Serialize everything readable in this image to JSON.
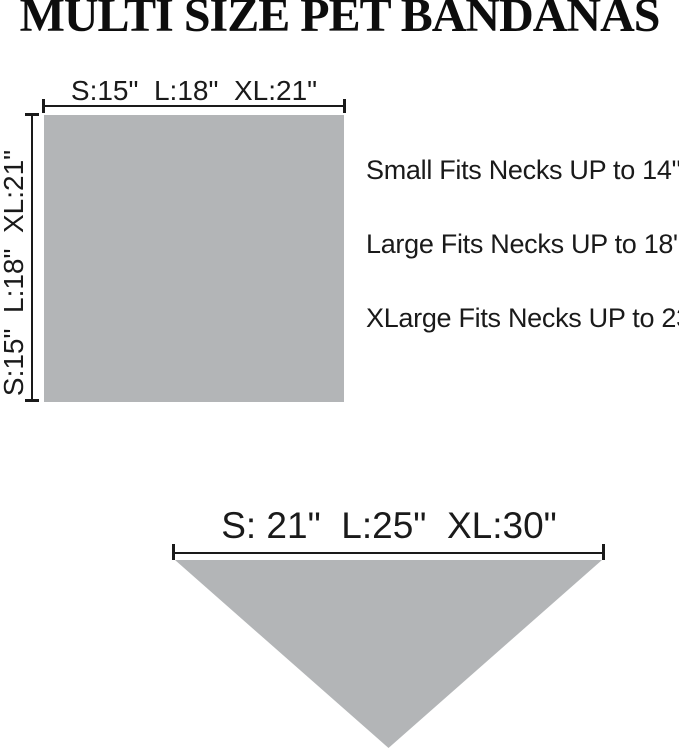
{
  "title": "MULTI SIZE PET BANDANAS",
  "colors": {
    "shape_fill": "#b3b5b7",
    "line": "#1a1a1a",
    "text": "#1a1a1a"
  },
  "square_diagram": {
    "width_label": "S:15\"  L:18\"  XL:21\"",
    "height_label": "S:15\"  L:18\"  XL:21\""
  },
  "fit_notes": [
    "Small Fits Necks UP to 14\"",
    "Large Fits Necks UP to 18\"",
    "XLarge Fits Necks UP to 23\""
  ],
  "triangle_diagram": {
    "width_label": "S: 21\"  L:25\"  XL:30\""
  }
}
